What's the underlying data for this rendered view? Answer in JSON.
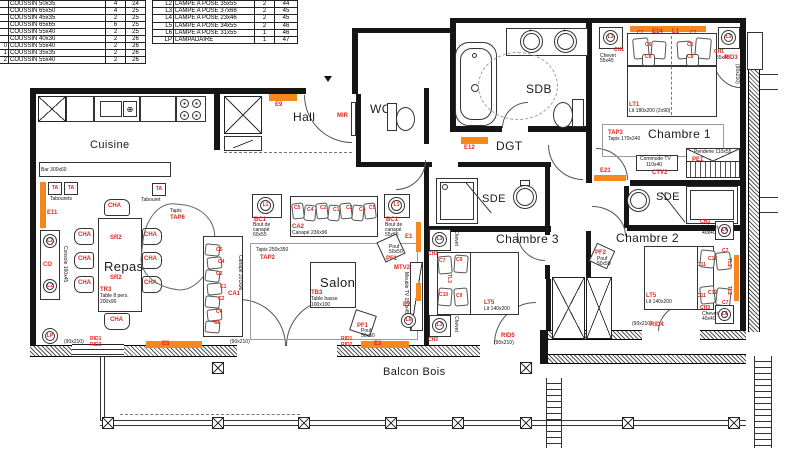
{
  "colors": {
    "label_red": "#e0261b",
    "bar_orange": "#f5871f",
    "wall_black": "#151515"
  },
  "legend": {
    "coussins": {
      "rows": [
        [
          "",
          "COUSSIN 50x35",
          "4",
          "24"
        ],
        [
          "",
          "COUSSIN 65x50",
          "4",
          "25"
        ],
        [
          "",
          "COUSSIN 45x35",
          "2",
          "25"
        ],
        [
          "",
          "COUSSIN 65x65",
          "6",
          "25"
        ],
        [
          "",
          "COUSSIN 55x40",
          "2",
          "25"
        ],
        [
          "",
          "COUSSIN 40x30",
          "2",
          "26"
        ],
        [
          "0",
          "COUSSIN 55x40",
          "2",
          "26"
        ],
        [
          "1",
          "COUSSIN 35x35",
          "2",
          "26"
        ],
        [
          "2",
          "COUSSIN 55x40",
          "2",
          "26"
        ]
      ]
    },
    "lampes": {
      "rows": [
        [
          "L2",
          "LAMPE A POSE 35x55",
          "2",
          "44"
        ],
        [
          "L3",
          "LAMPE A POSE 37x68",
          "2",
          "45"
        ],
        [
          "L4",
          "LAMPE A POSE 23x46",
          "2",
          "45"
        ],
        [
          "L5",
          "LAMPE A POSE 34x55",
          "2",
          "46"
        ],
        [
          "L6",
          "LAMPE A POSE 31x55",
          "1",
          "46"
        ],
        [
          "LP",
          "LAMPADAIRE",
          "1",
          "47"
        ]
      ]
    }
  },
  "t": {
    "cuisine": "Cuisine",
    "repas": "Repas",
    "salon": "Salon",
    "hall": "Hall",
    "wc": "WC",
    "sdb": "SDB",
    "dgt": "DGT",
    "sde": "SDE",
    "ch1room": "Chambre 1",
    "ch2room": "Chambre 2",
    "ch3room": "Chambre 3",
    "balcon": "Balcon Bois",
    "bar": "Bar 300x60",
    "ta": "TA",
    "tabourets": "Tabourets",
    "tabouret": "Tabouret",
    "cha": "CHA",
    "sr2": "SR2",
    "tr3": "TR3",
    "table8": "Table 8 pers.",
    "d200x90": "200x90",
    "co": "CO",
    "console": "Console 160x45",
    "lp": "LP",
    "l1": "L1",
    "l2": "L2",
    "l3": "L3",
    "l4": "L4",
    "l6": "L6",
    "tapis": "Tapis",
    "tap6": "TAP6",
    "tap2": "TAP2",
    "tapis250": "Tapis 250x350",
    "tap3": "TAP3",
    "tapis170": "Tapis 170x240",
    "ca1": "CA1",
    "ca2": "CA2",
    "canape236": "Canapé 236x96",
    "canape201": "Canapé 201x96",
    "bc1": "BC1",
    "boutde": "Bout de",
    "canape": "canapé",
    "d60x55": "60x55",
    "d55x55": "55x55",
    "c1": "C1",
    "c2": "C2",
    "c4": "C4",
    "c5": "C5",
    "c6": "C6",
    "c7": "C7",
    "c8": "C8",
    "c9": "C9",
    "c10": "C10",
    "c11": "C11",
    "c12": "C12",
    "tl2": "TL2",
    "tl3": "TL3",
    "tb3": "TB3",
    "tablebasse": "Table basse",
    "d100x100": "100x100",
    "pf1": "PF1",
    "pf2": "PF2",
    "pouf": "Pouf",
    "d50x50": "50x50",
    "mtv2": "MTV2",
    "meubletv": "Meuble TV 150x45",
    "lt1": "LT1",
    "lit180": "Lit 180x200 (2x90)",
    "lt5": "LT5",
    "lit140": "Lit 140x200",
    "ch1": "CH1",
    "ch2": "CH2",
    "ch3": "CH3",
    "chevet": "Chevet",
    "d55x45": "55x45",
    "d40x40": "40x40",
    "commodetv": "Commode TV",
    "d110x40": "110x40",
    "ctv2": "CTV2",
    "pe1": "PE1",
    "penderie": "Penderie 110x55",
    "mir": "MIR",
    "rid1": "RID1",
    "rid2": "RID2",
    "rid3": "RID3",
    "rid4": "RID4",
    "rid5": "RID5",
    "d90x210": "(90x210)",
    "e1": "E1",
    "e2": "E2",
    "e3": "E3",
    "e5": "E5",
    "e9": "E9",
    "e11": "E11",
    "e12": "E12",
    "e14": "E14",
    "e21": "E21"
  }
}
